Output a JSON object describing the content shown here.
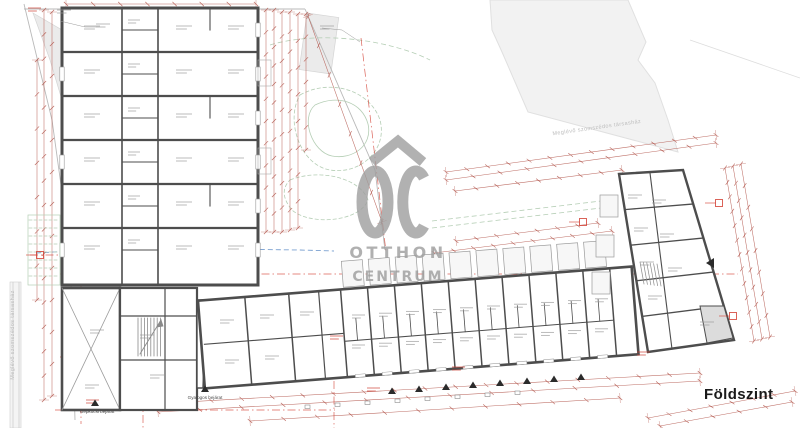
{
  "drawing": {
    "type": "architectural-floor-plan",
    "floor_label": "Földszint"
  },
  "watermark": {
    "monogram": "OC",
    "line1": "OTTHON",
    "line2": "CENTRUM"
  },
  "labels": {
    "neighbor_top": "Meglévő szomszédos társasház",
    "neighbor_left": "Meglévő szomszédos társasház",
    "entrance_pedestrian": "Gyalogos bejárat",
    "entrance_vehicle": "Gépkocsi bejárat"
  },
  "colors": {
    "wall": "#4d4d4d",
    "dimension_red": "#b2544a",
    "axis_red": "#d23b2f",
    "watermark_gray": "#9d9d9d",
    "landscape_green": "#b5ceb5",
    "utility_blue": "#7aa0d0",
    "neighbor_fill": "#f2f2f2"
  }
}
